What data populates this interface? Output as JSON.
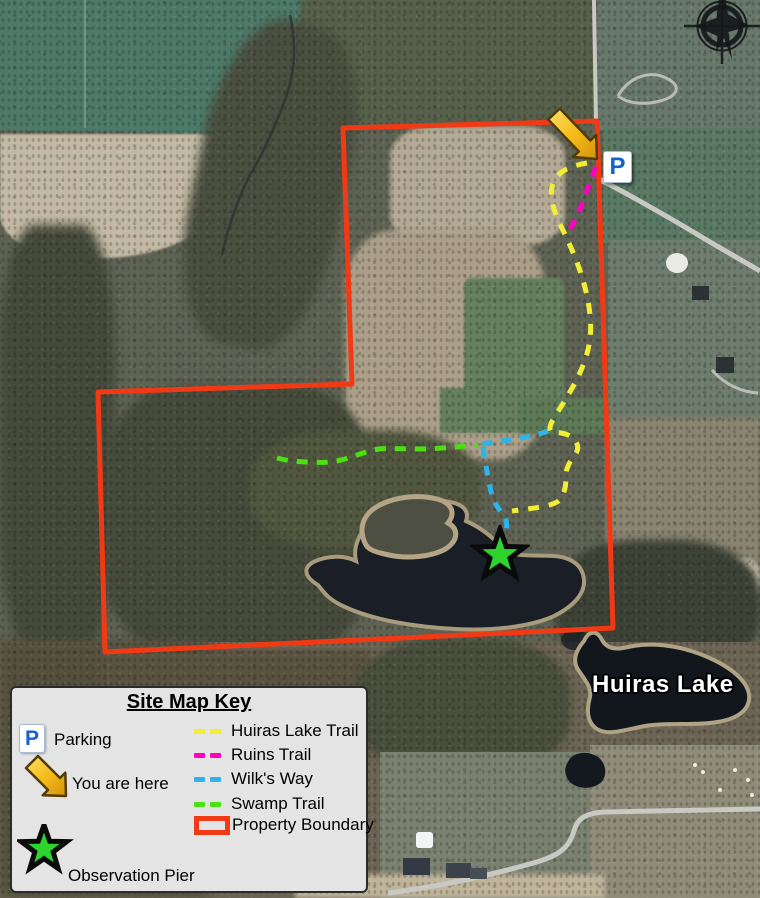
{
  "map": {
    "lake_label": "Huiras Lake",
    "parking_letter": "P"
  },
  "legend": {
    "title": "Site Map Key",
    "parking_label": "Parking",
    "you_are_here_label": "You are here",
    "observation_pier_label": "Observation Pier",
    "boundary_label": "Property Boundary",
    "trails": [
      {
        "label": "Huiras Lake Trail"
      },
      {
        "label": "Ruins Trail"
      },
      {
        "label": "Wilk's Way"
      },
      {
        "label": "Swamp Trail"
      }
    ]
  },
  "icons": {
    "compass": "north-arrow-icon",
    "parking": "parking-icon",
    "you_are_here": "you-are-here-arrow-icon",
    "observation_pier": "star-icon"
  },
  "colors": {
    "huiras_lake_trail": "#f1ee35",
    "ruins_trail": "#ff00c0",
    "wilks_way": "#2db4e8",
    "swamp_trail": "#4ae011",
    "property_boundary": "#f13a15",
    "observation_star": "#2fd32f",
    "parking_blue": "#1463cc"
  }
}
